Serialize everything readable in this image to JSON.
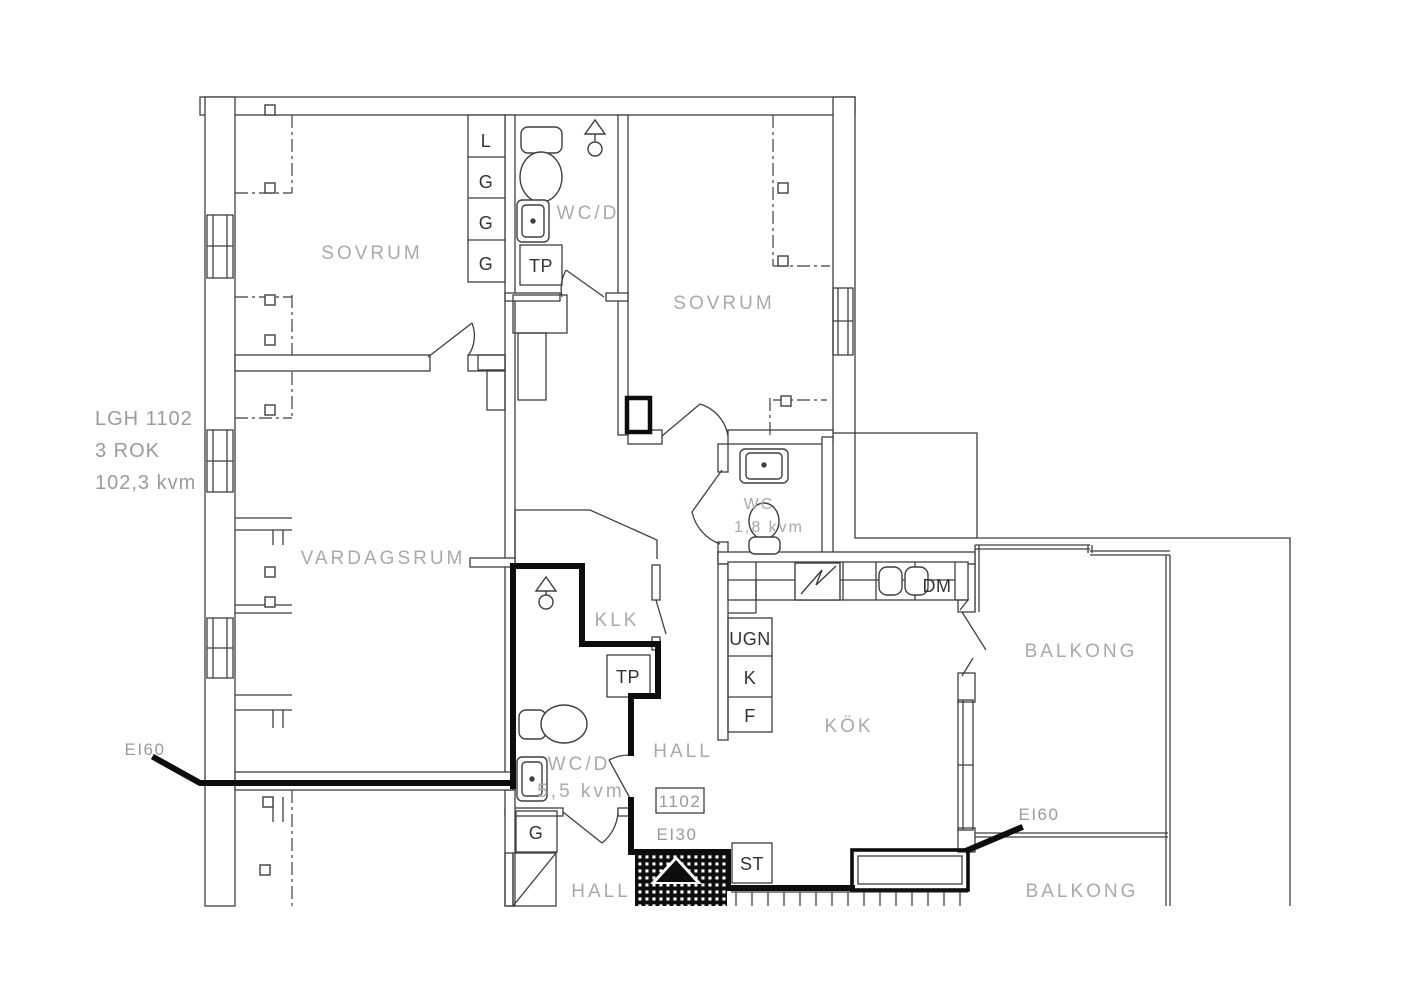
{
  "colors": {
    "wall_line": "#3f3f3f",
    "fire_wall": "#0d0d0d",
    "room_label": "#a9a9a9",
    "small_label": "#333333",
    "gray_label": "#9b9b9b"
  },
  "apartment": {
    "id": "LGH 1102",
    "rooms_count": "3 ROK",
    "area": "102,3 kvm",
    "number_badge": "1102"
  },
  "rooms": {
    "sovrum1": "SOVRUM",
    "sovrum2": "SOVRUM",
    "vardagsrum": "VARDAGSRUM",
    "wcd_top": "WC/D",
    "klk": "KLK",
    "wc_small": "WC",
    "wc_small_area": "1,8 kvm",
    "wcd_mid": "WC/D",
    "wcd_mid_area": "5,5 kvm",
    "hall_mid": "HALL",
    "hall_low": "HALL",
    "kok": "KÖK",
    "balkong_top": "BALKONG",
    "balkong_bottom": "BALKONG"
  },
  "closets": {
    "linen": "L",
    "g1": "G",
    "g2": "G",
    "g3": "G",
    "g_low": "G",
    "st": "ST",
    "tp_top": "TP",
    "tp_mid": "TP"
  },
  "appliances": {
    "oven": "UGN",
    "fridge": "K",
    "freezer": "F",
    "dishwasher": "DM"
  },
  "fire_ratings": {
    "ei60_left": "EI60",
    "ei60_right": "EI60",
    "ei30": "EI30"
  }
}
